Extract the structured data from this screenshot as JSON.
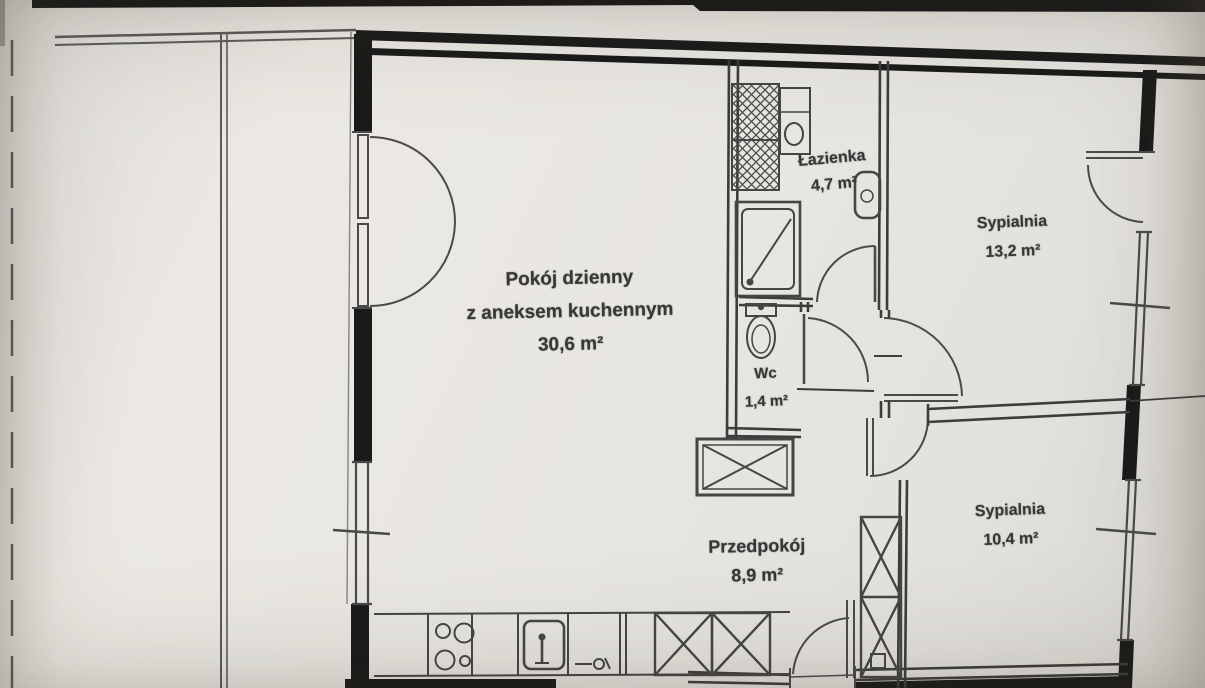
{
  "rooms": [
    {
      "key": "living-room",
      "lines": [
        "Pokój dzienny",
        "z aneksem kuchennym",
        "30,6 m²"
      ]
    },
    {
      "key": "bathroom",
      "lines": [
        "Łazienka",
        "4,7 m²"
      ]
    },
    {
      "key": "bedroom-1",
      "lines": [
        "Sypialnia",
        "13,2 m²"
      ]
    },
    {
      "key": "wc",
      "lines": [
        "Wc",
        "1,4 m²"
      ]
    },
    {
      "key": "hallway",
      "lines": [
        "Przedpokój",
        "8,9 m²"
      ]
    },
    {
      "key": "bedroom-2",
      "lines": [
        "Sypialnia",
        "10,4 m²"
      ]
    }
  ],
  "fixtures": [
    "washing-machine",
    "washbasin",
    "shower",
    "boiler",
    "toilet",
    "cooktop",
    "kitchen-sink",
    "kitchen-cabinets",
    "wardrobe",
    "installation-shaft",
    "entrance-door",
    "balcony-door",
    "french-door",
    "window"
  ],
  "colors": {
    "paper": "#e8e6e1",
    "ink": "#3f3f3f",
    "wall": "#1a1a1a"
  }
}
